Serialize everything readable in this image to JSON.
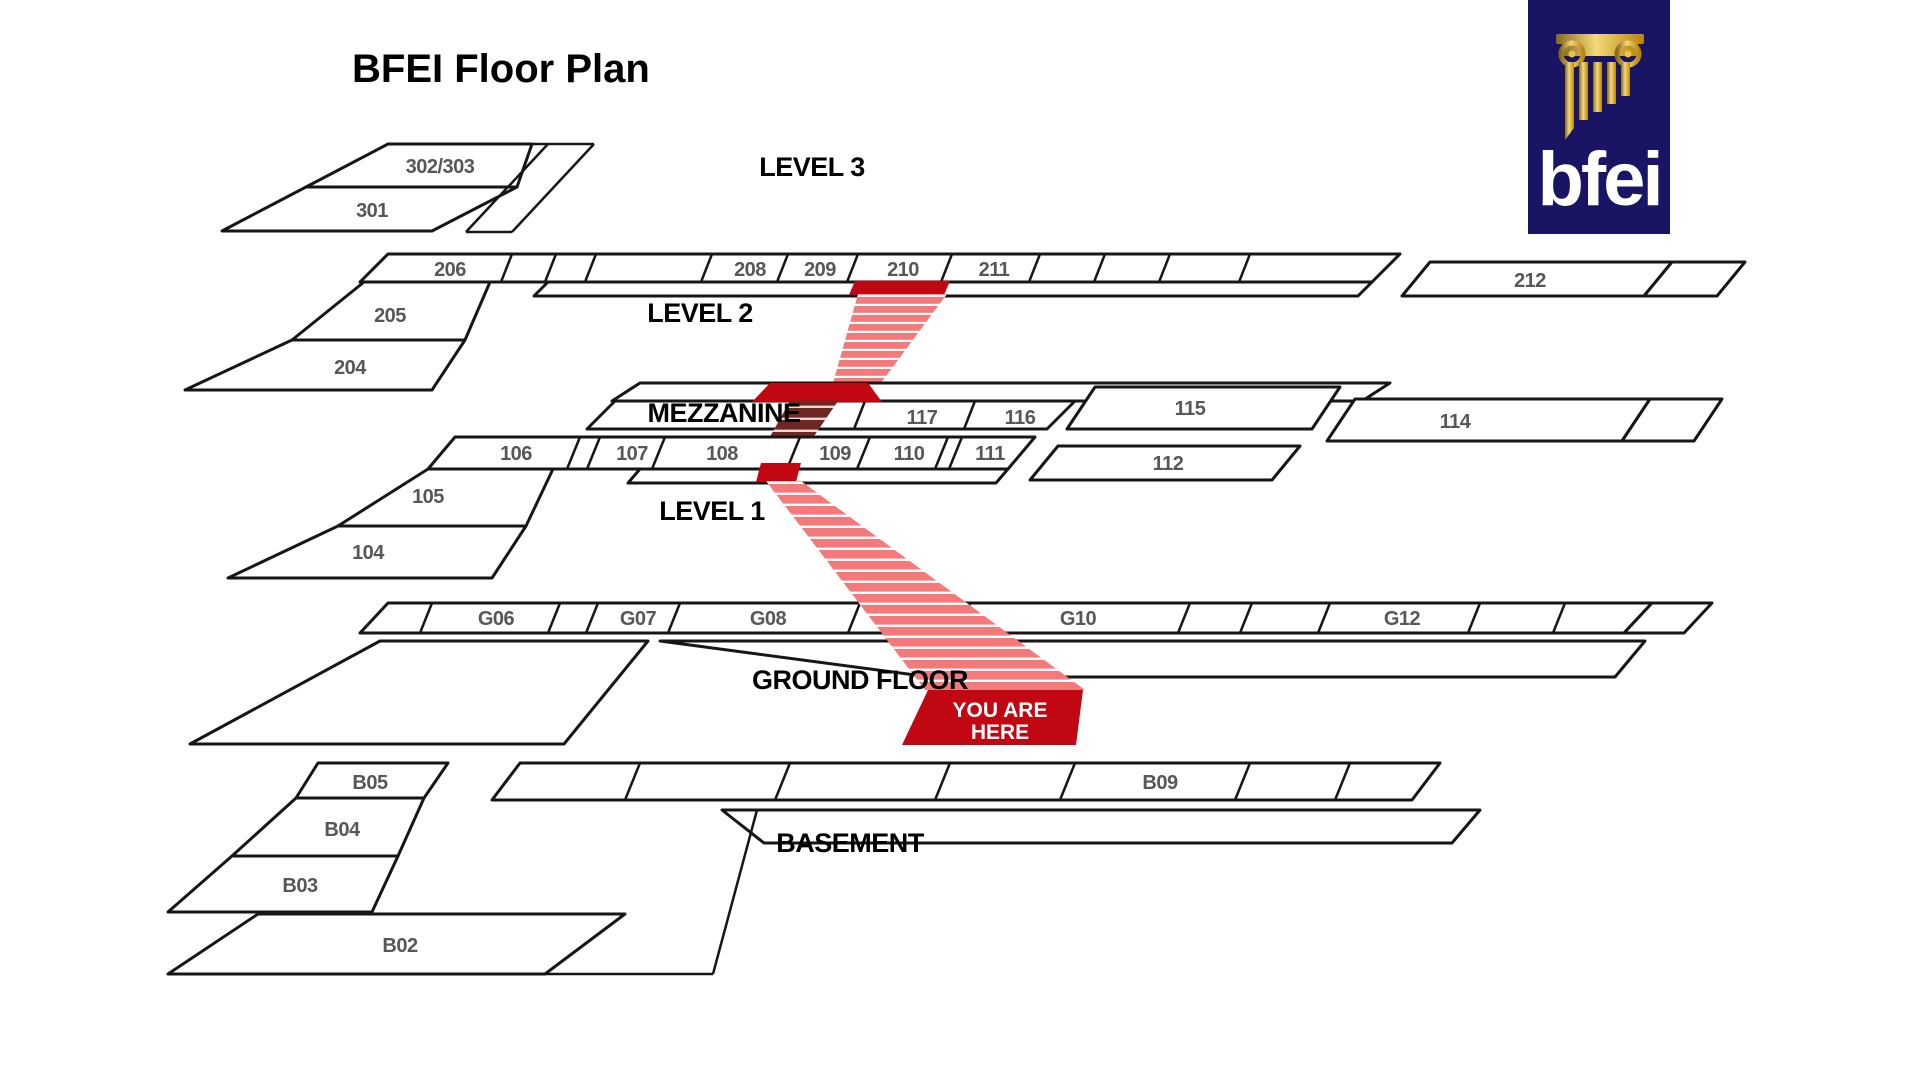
{
  "title": "BFEI Floor Plan",
  "logo": {
    "text": "bfei"
  },
  "floors": {
    "level3": {
      "label": "LEVEL 3",
      "rooms": [
        "302/303",
        "301"
      ]
    },
    "level2": {
      "label": "LEVEL 2",
      "rooms": [
        "206",
        "205",
        "204",
        "208",
        "209",
        "210",
        "211",
        "212"
      ]
    },
    "mezzanine": {
      "label": "MEZZANINE",
      "rooms": [
        "117",
        "116",
        "115",
        "114"
      ]
    },
    "level1": {
      "label": "LEVEL 1",
      "rooms": [
        "106",
        "105",
        "104",
        "107",
        "108",
        "109",
        "110",
        "111",
        "112"
      ]
    },
    "ground": {
      "label": "GROUND FLOOR",
      "rooms": [
        "G06",
        "G07",
        "G08",
        "G10",
        "G12"
      ]
    },
    "basement": {
      "label": "BASEMENT",
      "rooms": [
        "B05",
        "B04",
        "B03",
        "B02",
        "B09"
      ]
    }
  },
  "you_are_here": {
    "line1": "YOU ARE",
    "line2": "HERE"
  },
  "colors": {
    "marker_red": "#C00712",
    "stair_pink": "#F4797B",
    "stair_maroon": "#6E2723",
    "outline": "#161616",
    "room_label": "#575757",
    "logo_navy": "#1A1464",
    "logo_gold": "#D4A82C"
  }
}
